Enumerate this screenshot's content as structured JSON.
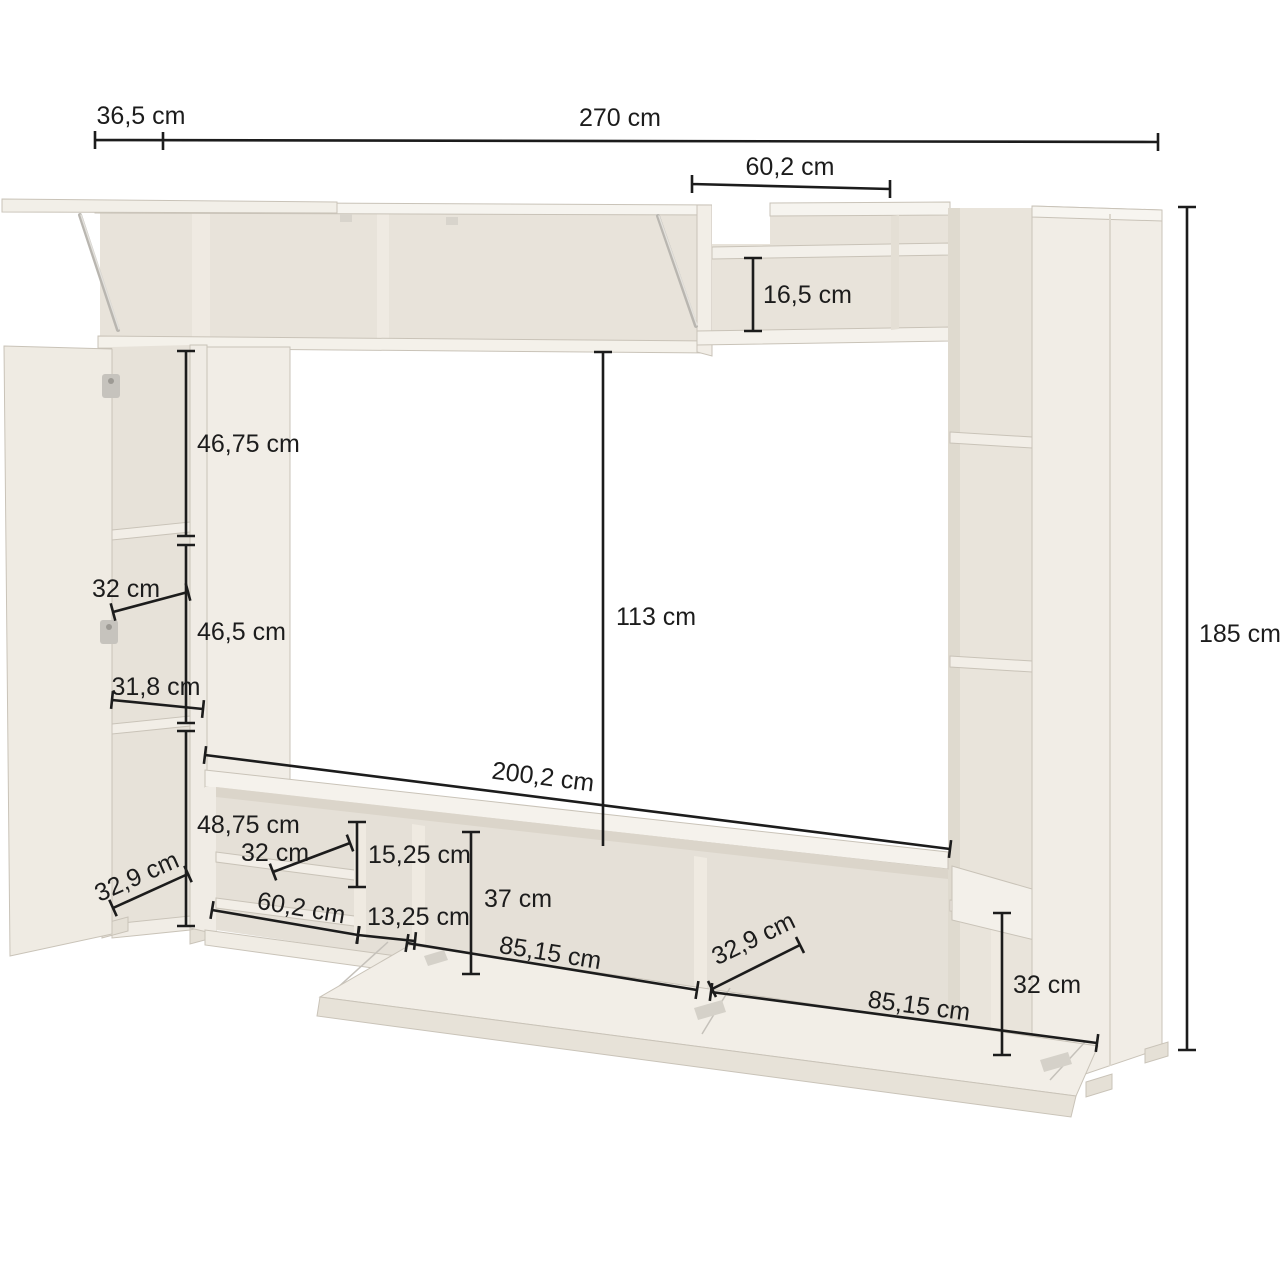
{
  "meta": {
    "type": "furniture dimension diagram",
    "subject": "TV wall unit / entertainment centre line drawing with open doors and drop-down flap",
    "units": "cm"
  },
  "palette": {
    "background": "#ffffff",
    "dimension_line": "#1c1c1c",
    "label_text": "#1c1c1c",
    "panel_face": "#f1ede6",
    "panel_top": "#f6f4ef",
    "interior_back": "#e8e3da",
    "edge_line": "#c9c3b8"
  },
  "dimensions": {
    "d365": {
      "label": "36,5 cm",
      "value_cm": 36.5,
      "orientation": "horizontal-top"
    },
    "d270": {
      "label": "270 cm",
      "value_cm": 270,
      "orientation": "horizontal-top"
    },
    "d602_top": {
      "label": "60,2 cm",
      "value_cm": 60.2,
      "orientation": "horizontal"
    },
    "d165": {
      "label": "16,5 cm",
      "value_cm": 16.5,
      "orientation": "vertical"
    },
    "d185": {
      "label": "185 cm",
      "value_cm": 185,
      "orientation": "vertical-right"
    },
    "d4675": {
      "label": "46,75 cm",
      "value_cm": 46.75,
      "orientation": "vertical"
    },
    "d32_left": {
      "label": "32 cm",
      "value_cm": 32,
      "orientation": "depth"
    },
    "d465": {
      "label": "46,5 cm",
      "value_cm": 46.5,
      "orientation": "vertical"
    },
    "d318": {
      "label": "31,8 cm",
      "value_cm": 31.8,
      "orientation": "horizontal"
    },
    "d4875": {
      "label": "48,75 cm",
      "value_cm": 48.75,
      "orientation": "vertical"
    },
    "d329_left": {
      "label": "32,9 cm",
      "value_cm": 32.9,
      "orientation": "depth"
    },
    "d113": {
      "label": "113 cm",
      "value_cm": 113,
      "orientation": "vertical"
    },
    "d2002": {
      "label": "200,2 cm",
      "value_cm": 200.2,
      "orientation": "horizontal"
    },
    "d32_stand": {
      "label": "32 cm",
      "value_cm": 32,
      "orientation": "depth"
    },
    "d1525": {
      "label": "15,25 cm",
      "value_cm": 15.25,
      "orientation": "vertical"
    },
    "d602_stand": {
      "label": "60,2 cm",
      "value_cm": 60.2,
      "orientation": "horizontal"
    },
    "d1325": {
      "label": "13,25 cm",
      "value_cm": 13.25,
      "orientation": "horizontal"
    },
    "d37": {
      "label": "37 cm",
      "value_cm": 37,
      "orientation": "vertical"
    },
    "d8515_left": {
      "label": "85,15 cm",
      "value_cm": 85.15,
      "orientation": "horizontal"
    },
    "d329_right": {
      "label": "32,9 cm",
      "value_cm": 32.9,
      "orientation": "depth"
    },
    "d8515_right": {
      "label": "85,15 cm",
      "value_cm": 85.15,
      "orientation": "horizontal"
    },
    "d32_right": {
      "label": "32 cm",
      "value_cm": 32,
      "orientation": "vertical"
    }
  }
}
